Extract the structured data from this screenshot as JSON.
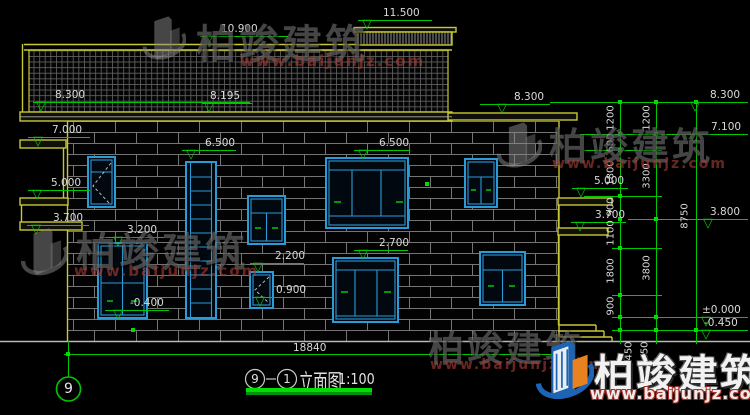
{
  "drawing": {
    "ground_dim": "18840",
    "title": {
      "axis_a": "9",
      "axis_b": "1",
      "name": "立面图",
      "scale": "1:100"
    },
    "axis_bubble": "9"
  },
  "symbols": {
    "level_triangle": "▽"
  },
  "colors": {
    "line_green": "#00c800",
    "cad_yellow": "#c8c832",
    "window_blue": "#2b9bd8",
    "dim_text": "#d9d9d9",
    "background": "#000000",
    "underline_green": "#00e000"
  },
  "levels": [
    {
      "label": "11.500",
      "lx": 358,
      "ly": 20,
      "lw": 74,
      "tx": 383,
      "trx": 362
    },
    {
      "label": "10.900",
      "lx": 200,
      "ly": 36,
      "lw": 88,
      "tx": 221,
      "trx": 203
    },
    {
      "label": "8.300",
      "lx": 33,
      "ly": 102,
      "lw": 217,
      "tx": 55,
      "trx": 36
    },
    {
      "label": "8.195",
      "lx": 202,
      "ly": 103,
      "lw": 50,
      "tx": 210,
      "trx": 204
    },
    {
      "label": "7.000",
      "lx": 28,
      "ly": 137,
      "lw": 62,
      "tx": 52,
      "trx": 33
    },
    {
      "label": "6.500",
      "lx": 182,
      "ly": 150,
      "lw": 54,
      "tx": 205,
      "trx": 186
    },
    {
      "label": "6.500",
      "lx": 354,
      "ly": 150,
      "lw": 56,
      "tx": 379,
      "trx": 358
    },
    {
      "label": "5.000",
      "lx": 28,
      "ly": 190,
      "lw": 62,
      "tx": 51,
      "trx": 32
    },
    {
      "label": "3.700",
      "lx": 27,
      "ly": 225,
      "lw": 62,
      "tx": 53,
      "trx": 31
    },
    {
      "label": "3.200",
      "lx": 100,
      "ly": 237,
      "lw": 64,
      "tx": 127,
      "trx": 113
    },
    {
      "label": "2.200",
      "lx": 250,
      "ly": 263,
      "lw": 54,
      "tx": 275,
      "trx": 253
    },
    {
      "label": "2.700",
      "lx": 354,
      "ly": 250,
      "lw": 54,
      "tx": 379,
      "trx": 358
    },
    {
      "label": "0.900",
      "lx": 252,
      "ly": 297,
      "lw": 54,
      "tx": 276,
      "trx": 255
    },
    {
      "label": "-0.400",
      "lx": 105,
      "ly": 310,
      "lw": 64,
      "tx": 130,
      "trx": 113
    },
    {
      "label": "5.000",
      "lx": 572,
      "ly": 188,
      "lw": 56,
      "tx": 594,
      "trx": 576
    },
    {
      "label": "3.700",
      "lx": 571,
      "ly": 222,
      "lw": 55,
      "tx": 595,
      "trx": 575
    },
    {
      "label": "8.300",
      "lx": 480,
      "ly": 104,
      "lw": 70,
      "tx": 514,
      "trx": 497
    },
    {
      "label": "8.300",
      "lx": 685,
      "ly": 102,
      "lw": 63,
      "tx": 710,
      "trx": 690
    },
    {
      "label": "7.100",
      "lx": 685,
      "ly": 134,
      "lw": 63,
      "tx": 711,
      "trx": 689
    },
    {
      "label": "3.800",
      "lx": 700,
      "ly": 219,
      "lw": 48,
      "tx": 710,
      "trx": 703
    },
    {
      "label": "±0.000",
      "lx": 698,
      "ly": 317,
      "lw": 50,
      "tx": 702,
      "trx": 701
    },
    {
      "label": "-0.450",
      "lx": 698,
      "ly": 330,
      "lw": 50,
      "tx": 704,
      "trx": 701
    }
  ],
  "vdims": [
    {
      "label": "1200",
      "x": 611,
      "y": 118
    },
    {
      "label": "600",
      "x": 611,
      "y": 143
    },
    {
      "label": "1800",
      "x": 611,
      "y": 173
    },
    {
      "label": "900",
      "x": 611,
      "y": 207
    },
    {
      "label": "1100",
      "x": 611,
      "y": 233
    },
    {
      "label": "1800",
      "x": 611,
      "y": 271
    },
    {
      "label": "900",
      "x": 611,
      "y": 306
    },
    {
      "label": "1200",
      "x": 647,
      "y": 118
    },
    {
      "label": "3300",
      "x": 647,
      "y": 176
    },
    {
      "label": "3800",
      "x": 647,
      "y": 268
    },
    {
      "label": "8750",
      "x": 685,
      "y": 216
    },
    {
      "label": "450",
      "x": 629,
      "y": 351
    },
    {
      "label": "450",
      "x": 645,
      "y": 351
    }
  ],
  "watermark": {
    "brand": "柏竣建筑",
    "url": "www.baijunjz.com"
  }
}
